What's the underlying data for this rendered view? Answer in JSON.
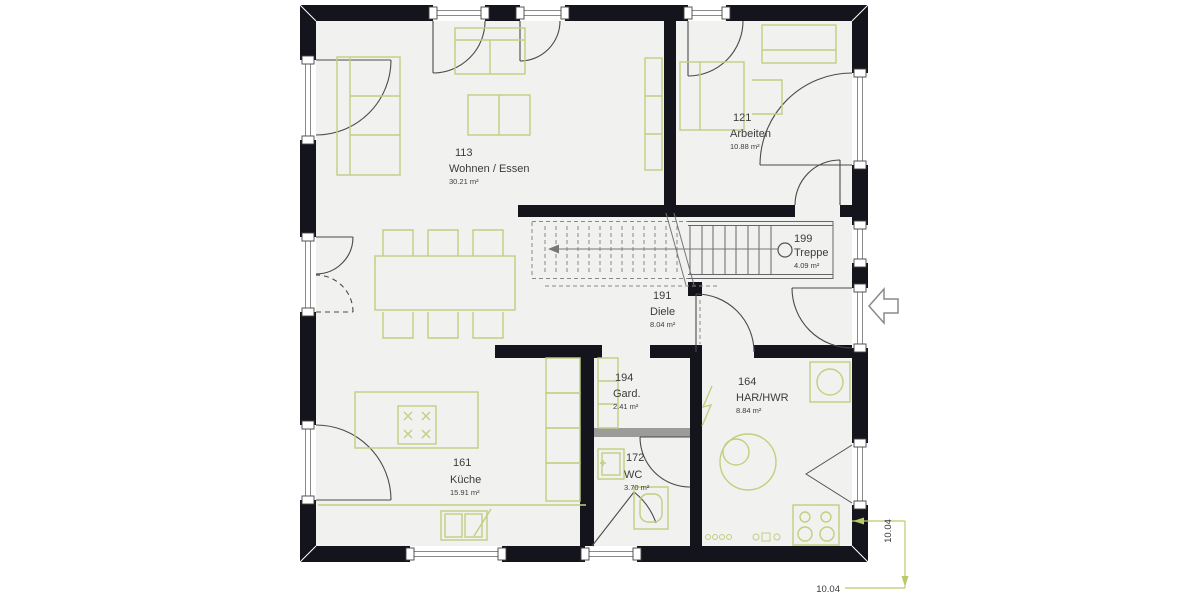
{
  "plan": {
    "title": "Grundriss Erdgeschoss",
    "rooms": [
      {
        "id": "113",
        "name": "Wohnen / Essen",
        "area": "30.21 m²"
      },
      {
        "id": "121",
        "name": "Arbeiten",
        "area": "10.88 m²"
      },
      {
        "id": "199",
        "name": "Treppe",
        "area": "4.09 m²"
      },
      {
        "id": "191",
        "name": "Diele",
        "area": "8.04 m²"
      },
      {
        "id": "194",
        "name": "Gard.",
        "area": "2.41 m²"
      },
      {
        "id": "164",
        "name": "HAR/HWR",
        "area": "8.84 m²"
      },
      {
        "id": "161",
        "name": "Küche",
        "area": "15.91 m²"
      },
      {
        "id": "172",
        "name": "WC",
        "area": "3.70 m²"
      }
    ],
    "dimensions": {
      "width": "10.04",
      "depth": "10.04"
    },
    "colors": {
      "wall": "#14141d",
      "floor": "#f1f1f0",
      "furniture": "#c3ce7f",
      "dimension_line": "#bcc96b",
      "door_line": "#4a4a4a",
      "lintel": "#9b9b9b"
    },
    "icons": [
      "entrance-arrow-icon",
      "stair-newel-icon",
      "hob-icon",
      "boiler-icon",
      "tank-icon",
      "lightning-icon"
    ]
  }
}
